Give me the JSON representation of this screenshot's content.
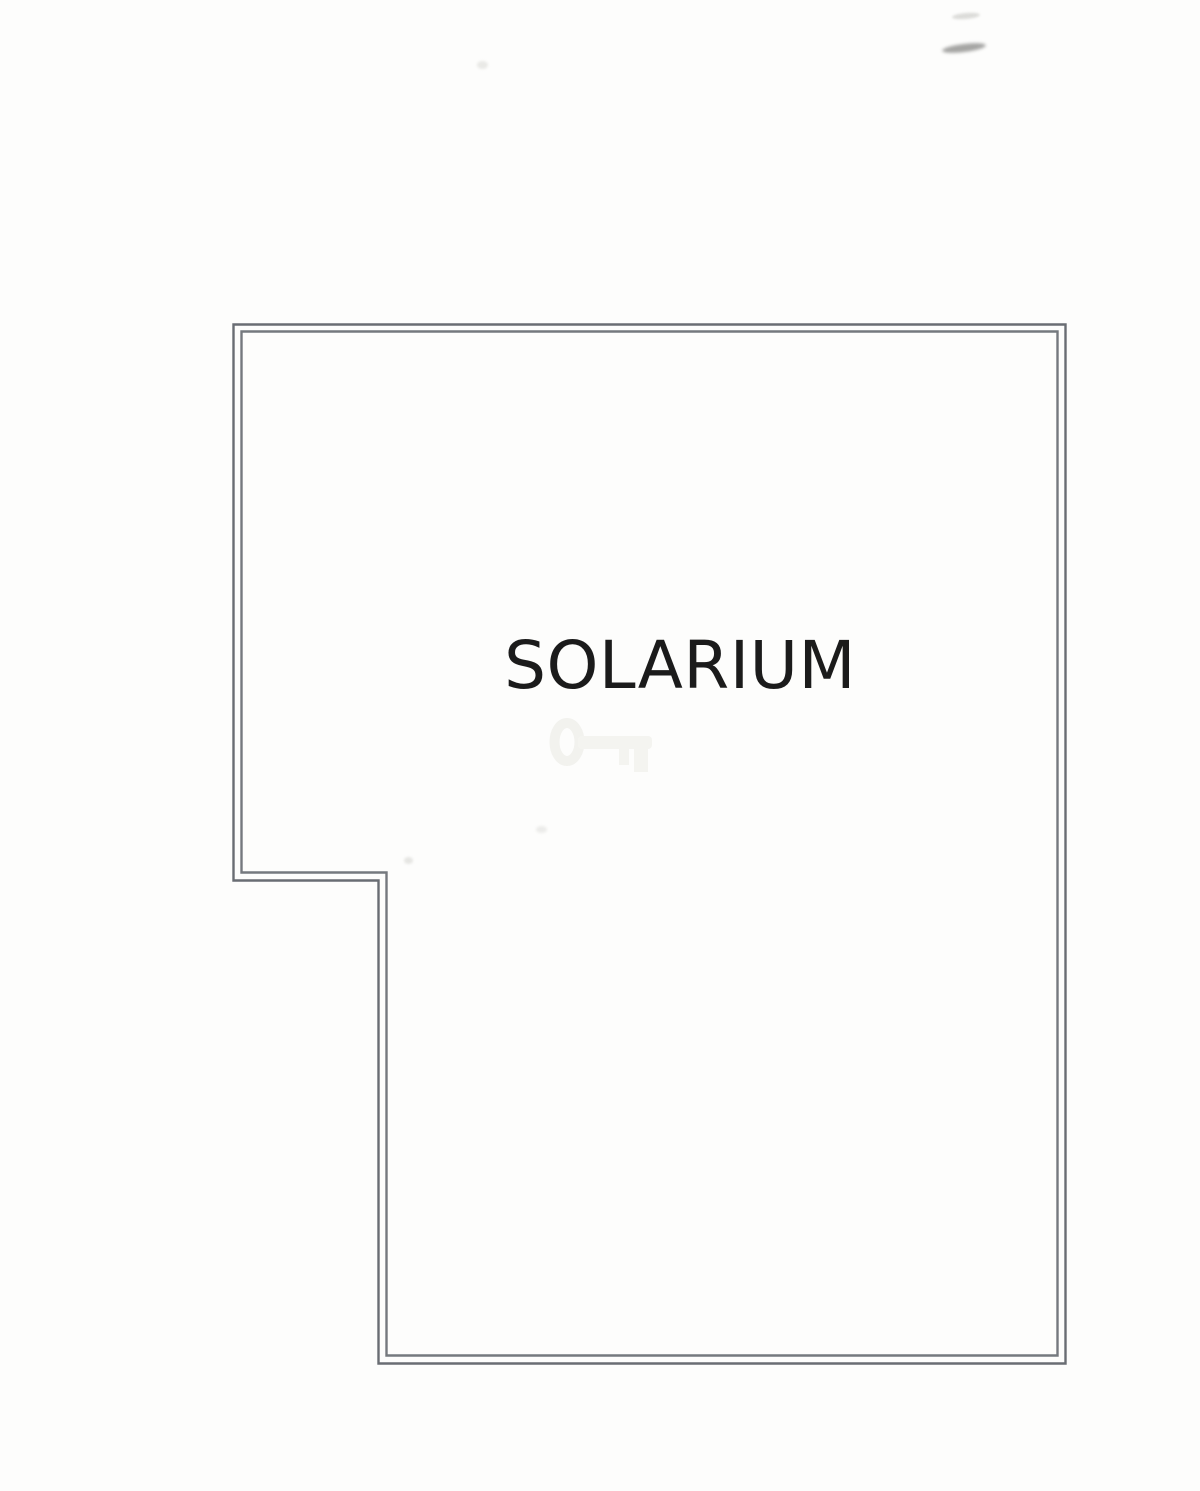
{
  "document": {
    "type": "floor-plan scan",
    "room": {
      "label": "SOLARIUM"
    },
    "colors": {
      "page_background": "#fdfdfc",
      "wall_line": "#6f7378",
      "label_text": "#1b1b1b",
      "watermark": "#f2f2ee"
    },
    "walls": {
      "outer_path": "M233.5,324.5 H1065.5 V1363.5 H378.5 V880.5 H233.5 Z",
      "inner_path": "M241.5,331.5 H1057.5 V1355.5 H386.5 V872.5 H241.5 Z"
    },
    "watermark_icon": "key-icon"
  }
}
